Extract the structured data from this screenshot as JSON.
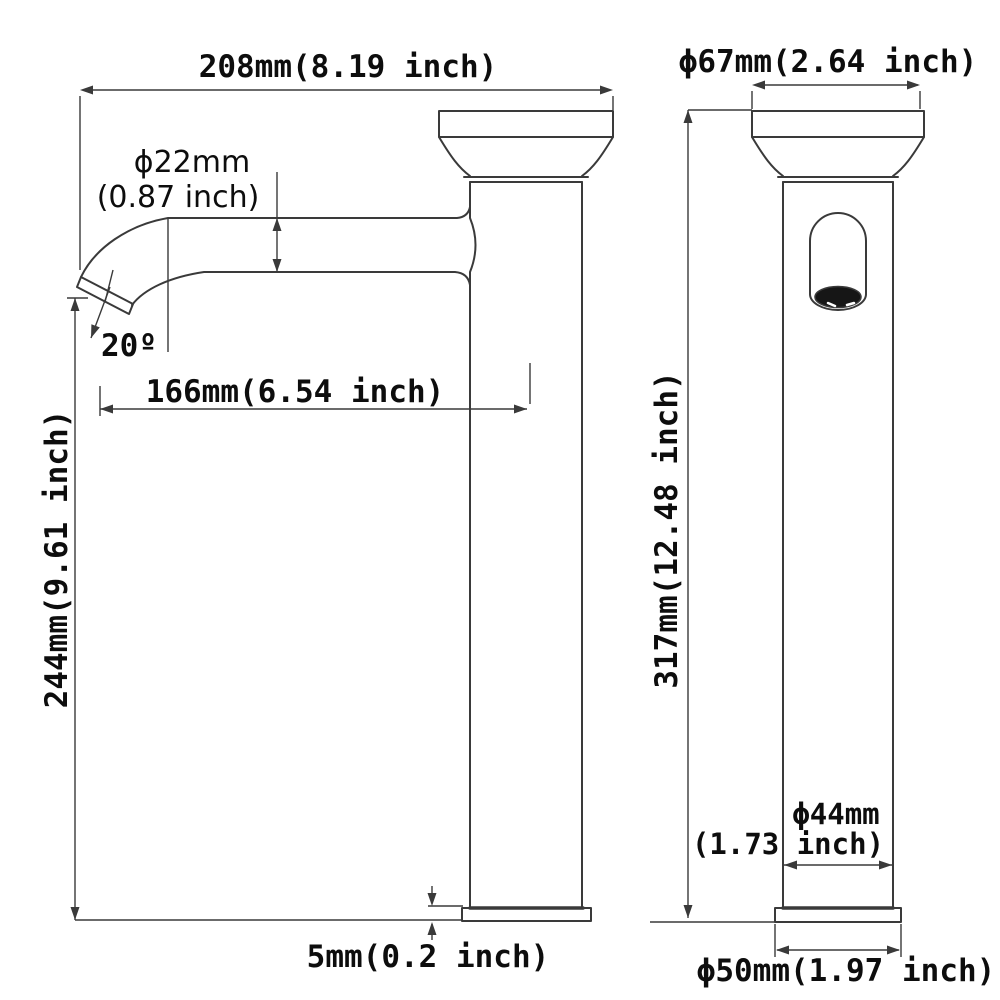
{
  "title": "faucet-dimension-drawing",
  "colors": {
    "line": "#3a3a3a",
    "text": "#0d0d0d",
    "background": "#ffffff",
    "aerator": "#161616"
  },
  "side_view": {
    "width_label": "208mm(8.19 inch)",
    "spout_diameter_label_line1": "ϕ22mm",
    "spout_diameter_label_line2": "(0.87 inch)",
    "spout_angle_label": "20º",
    "spout_reach_label": "166mm(6.54 inch)",
    "spout_height_label": "244mm(9.61 inch)",
    "base_thickness_label": "5mm(0.2 inch)"
  },
  "front_view": {
    "top_diameter_label": "ϕ67mm(2.64 inch)",
    "total_height_label": "317mm(12.48 inch)",
    "body_diameter_label_line1": "ϕ44mm",
    "body_diameter_label_line2": "(1.73 inch)",
    "base_diameter_label": "ϕ50mm(1.97 inch)"
  }
}
